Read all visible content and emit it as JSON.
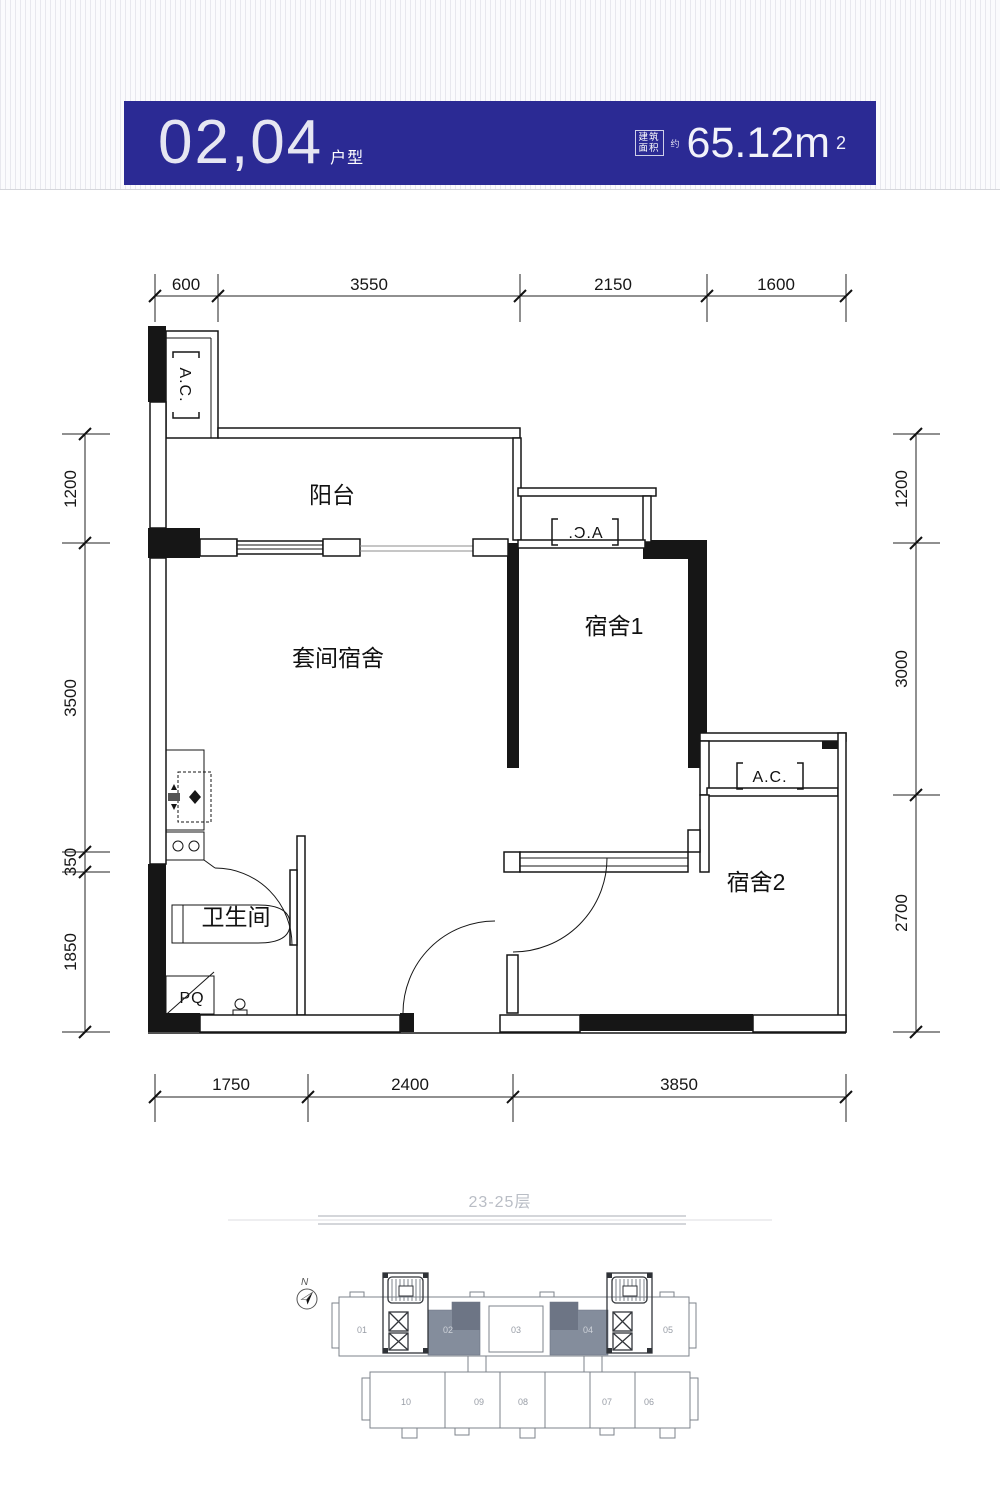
{
  "header": {
    "unit_numbers": "02,04",
    "unit_suffix": "户型",
    "area_box_line1": "建筑",
    "area_box_line2": "面积",
    "area_approx": "约",
    "area_value": "65.12m",
    "area_sup": "2",
    "bar_color": "#2b2a94"
  },
  "plan": {
    "rooms": {
      "balcony": "阳台",
      "suite": "套间宿舍",
      "dorm1": "宿舍1",
      "dorm2": "宿舍2",
      "bathroom": "卫生间"
    },
    "ac_label": "A.C.",
    "pq_label": "PQ",
    "dims": {
      "top": [
        "600",
        "3550",
        "2150",
        "1600"
      ],
      "bottom": [
        "1750",
        "2400",
        "3850"
      ],
      "left": [
        "1200",
        "3500",
        "350",
        "1850"
      ],
      "right": [
        "1200",
        "3000",
        "2700"
      ]
    }
  },
  "floor_note": "23-25层",
  "site": {
    "north": "N",
    "top_units": [
      "01",
      "02",
      "03",
      "04",
      "05"
    ],
    "bottom_units": [
      "10",
      "09",
      "08",
      "07",
      "06"
    ],
    "highlight_color": "#848d9c"
  }
}
